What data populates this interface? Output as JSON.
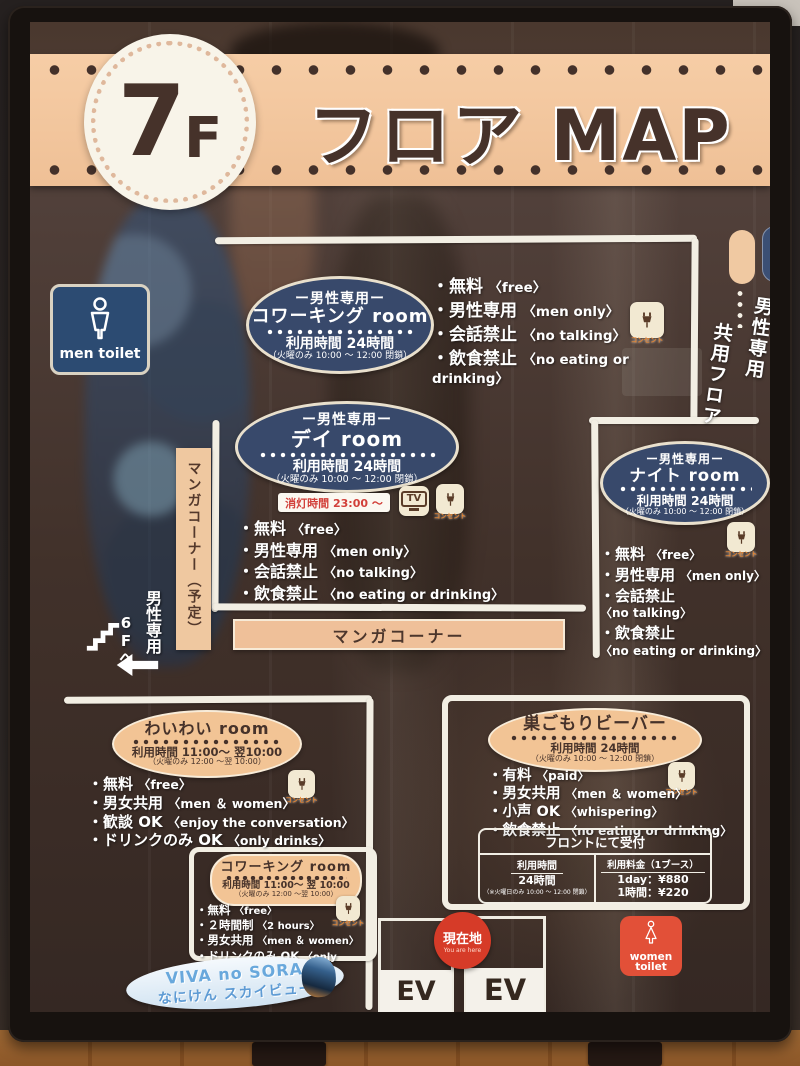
{
  "header": {
    "floor_big": "7",
    "floor_small": "F",
    "title": "フロア MAP"
  },
  "legend": {
    "shared": "共用フロア",
    "men": "男性専用"
  },
  "labels": {
    "outlet": "コンセント",
    "tv": "TV",
    "manga_bar": "マンガコーナー",
    "manga_planned": "マンガコーナー（予定）",
    "lights_out": "消灯時間 23:00 ～"
  },
  "toilets": {
    "men": "men toilet",
    "women_line1": "women",
    "women_line2": "toilet"
  },
  "stairs": {
    "line1": "男性専用",
    "line2": "6Fへ"
  },
  "current_location": {
    "label": "現在地",
    "sub": "You are here"
  },
  "elevators": [
    "EV",
    "EV"
  ],
  "viva": {
    "line1": "VIVA no SORA",
    "line2": "なにけん スカイビュー"
  },
  "rooms": {
    "coworking_top": {
      "tag": "ー男性専用ー",
      "name": "コワーキング room",
      "hours": "利用時間  24時間",
      "note": "（火曜のみ 10:00 ～ 12:00 閉鎖）",
      "bullets": [
        {
          "jp": "無料",
          "en": "〈free〉"
        },
        {
          "jp": "男性専用",
          "en": "〈men only〉"
        },
        {
          "jp": "会話禁止",
          "en": "〈no talking〉"
        },
        {
          "jp": "飲食禁止",
          "en": "〈no eating or drinking〉"
        }
      ]
    },
    "day": {
      "tag": "ー男性専用ー",
      "name": "デイ room",
      "hours": "利用時間  24時間",
      "note": "（火曜のみ 10:00 ～ 12:00 閉鎖）",
      "bullets": [
        {
          "jp": "無料",
          "en": "〈free〉"
        },
        {
          "jp": "男性専用",
          "en": "〈men only〉"
        },
        {
          "jp": "会話禁止",
          "en": "〈no talking〉"
        },
        {
          "jp": "飲食禁止",
          "en": "〈no eating or drinking〉"
        }
      ]
    },
    "night": {
      "tag": "ー男性専用ー",
      "name": "ナイト room",
      "hours": "利用時間  24時間",
      "note": "（火曜のみ 10:00 ～ 12:00 閉鎖）",
      "bullets": [
        {
          "jp": "無料",
          "en": "〈free〉"
        },
        {
          "jp": "男性専用",
          "en": "〈men only〉"
        },
        {
          "jp": "会話禁止",
          "en": "〈no talking〉"
        },
        {
          "jp": "飲食禁止",
          "en": "〈no eating or drinking〉"
        }
      ]
    },
    "waiwai": {
      "name": "わいわい room",
      "hours": "利用時間  11:00～ 翌10:00",
      "note": "（火曜のみ 12:00 ～翌 10:00）",
      "bullets": [
        {
          "jp": "無料",
          "en": "〈free〉"
        },
        {
          "jp": "男女共用",
          "en": "〈men ＆ women〉"
        },
        {
          "jp": "歓談 OK",
          "en": "〈enjoy the conversation〉"
        },
        {
          "jp": "ドリンクのみ OK",
          "en": "〈only drinks〉"
        }
      ]
    },
    "beaver": {
      "name": "巣ごもりビーバー",
      "hours": "利用時間  24時間",
      "note": "（火曜のみ 10:00 ～ 12:00 閉鎖）",
      "bullets": [
        {
          "jp": "有料",
          "en": "〈paid〉"
        },
        {
          "jp": "男女共用",
          "en": "〈men ＆ women〉"
        },
        {
          "jp": "小声 OK",
          "en": "〈whispering〉"
        },
        {
          "jp": "飲食禁止",
          "en": "〈no eating or drinking〉"
        }
      ],
      "reception": {
        "title": "フロントにて受付",
        "left_header": "利用時間",
        "left_value": "24時間",
        "left_note": "（※火曜日のみ 10:00 ～ 12:00 閉鎖）",
        "right_header": "利用料金（1ブース）",
        "right_row1": "1day：¥880",
        "right_row2": "1時間：¥220"
      }
    },
    "coworking_bottom": {
      "name": "コワーキング room",
      "hours": "利用時間  11:00～ 翌 10:00",
      "note": "（火曜のみ 12:00 ～翌 10:00）",
      "bullets": [
        {
          "jp": "無料",
          "en": "〈free〉"
        },
        {
          "jp": "２時間制",
          "en": "〈2 hours〉"
        },
        {
          "jp": "男女共用",
          "en": "〈men ＆ women〉"
        },
        {
          "jp": "ドリンクのみ OK",
          "en": "〈only drinks〉"
        }
      ]
    }
  },
  "colors": {
    "banner_peach": "#efc096",
    "oval_navy": "#38496b",
    "oval_peach": "#f2c495",
    "you_are_here_red": "#d63b28",
    "women_toilet_red": "#e25038",
    "men_toilet_navy": "#2c4b72"
  }
}
